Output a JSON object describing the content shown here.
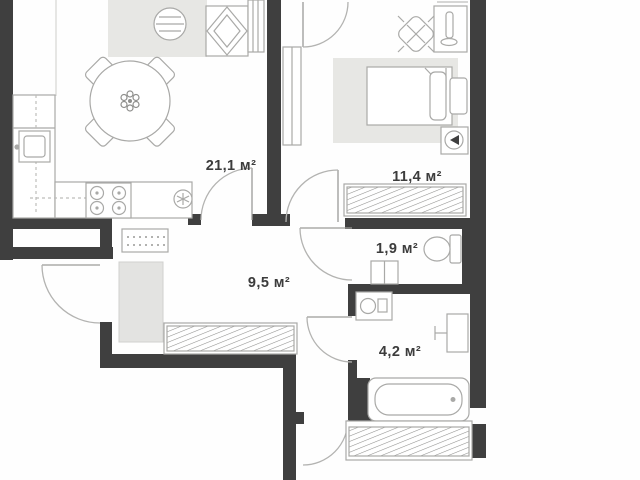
{
  "plan": {
    "type": "apartment-floor-plan",
    "rooms": [
      {
        "id": "kitchen-living-room",
        "area_label": "21,1 м²"
      },
      {
        "id": "bedroom",
        "area_label": "11,4 м²"
      },
      {
        "id": "hallway",
        "area_label": "9,5 м²"
      },
      {
        "id": "wc",
        "area_label": "1,9 м²"
      },
      {
        "id": "bathroom",
        "area_label": "4,2 м²"
      }
    ],
    "icons": [
      "dining-table-icon",
      "armchair-icon",
      "coffee-table-icon",
      "stove-icon",
      "kitchen-sink-icon",
      "bed-icon",
      "desk-icon",
      "desk-chair-icon",
      "wardrobe-hatch-icon",
      "toilet-icon",
      "washbasin-icon",
      "washing-machine-icon",
      "bathtub-icon",
      "bathroom-sink-icon",
      "door-arc-icon",
      "rug-icon",
      "cabinet-icon",
      "shoe-rack-icon",
      "media-box-icon"
    ],
    "colors": {
      "wall": "#3f3f3f",
      "furniture_line": "#a9a9a7",
      "rug_fill": "#e7e7e4",
      "cabinet_fill": "#e3e3e1",
      "hatch_line": "#8f8f8d",
      "label_text": "#3c3c3c",
      "background": "#fefefe"
    }
  }
}
